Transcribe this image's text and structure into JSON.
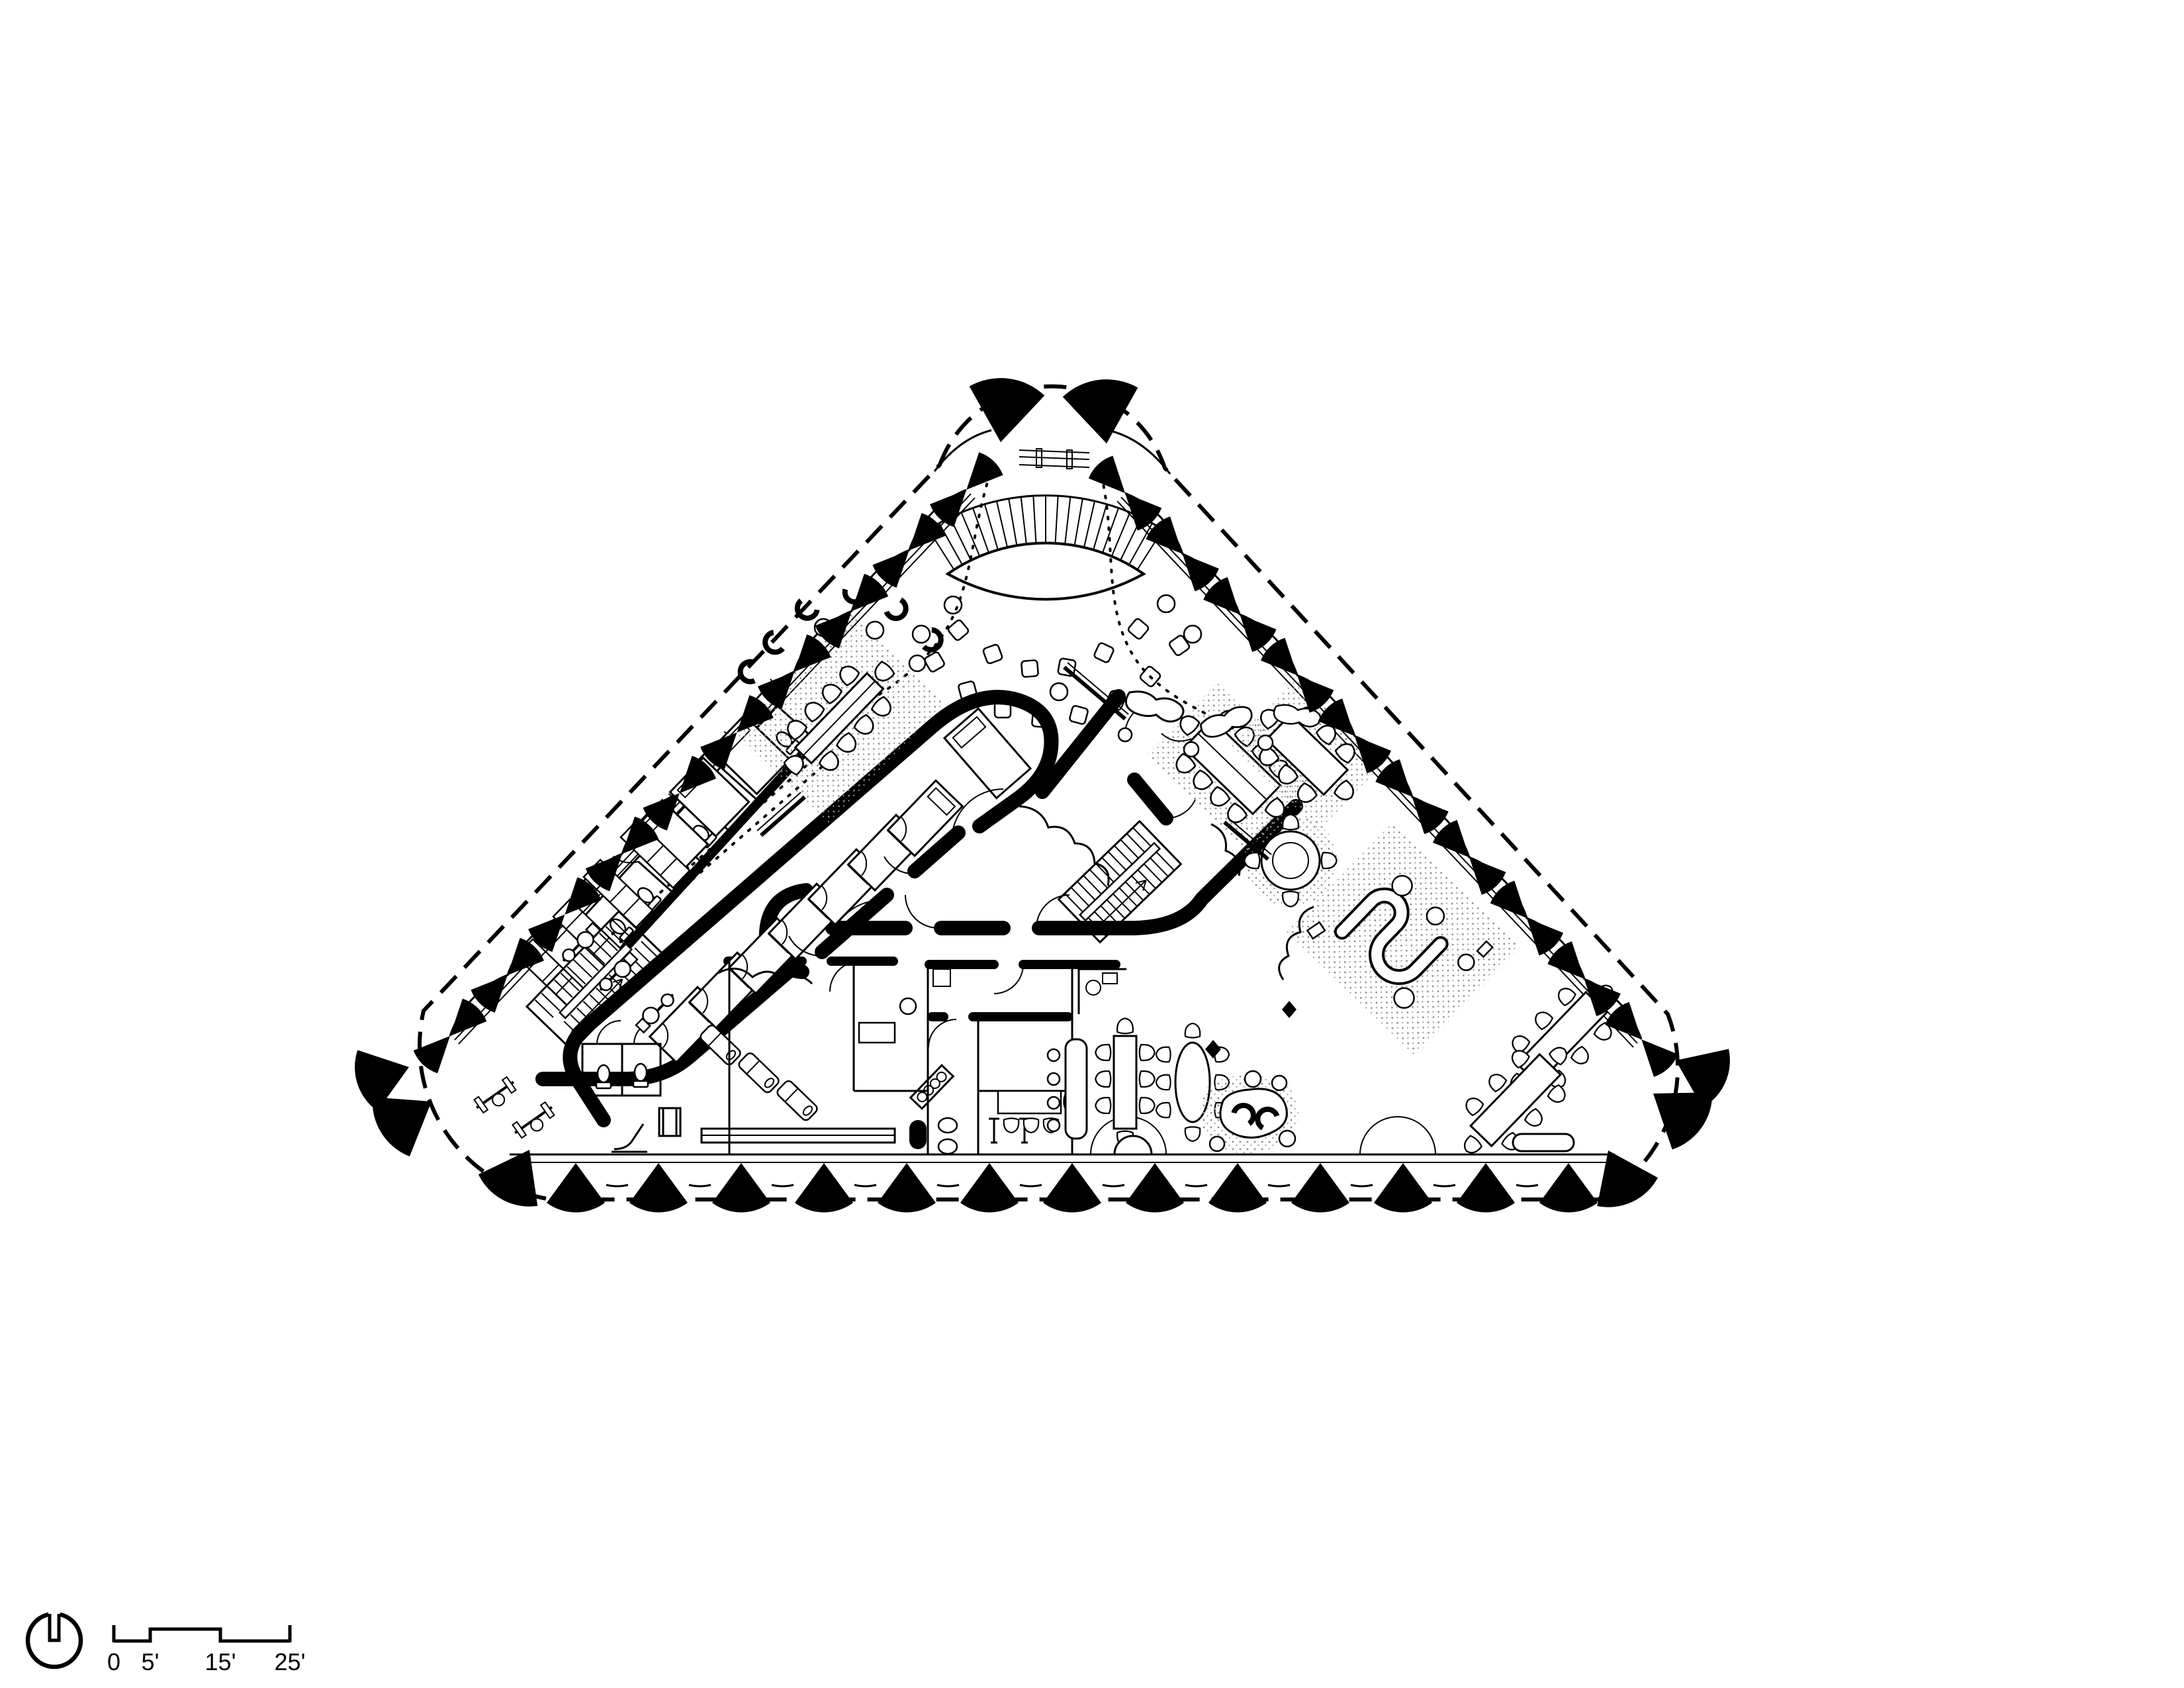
{
  "sheet": {
    "type": "architectural floor plan drawing",
    "background_color": "#ffffff",
    "ink_color": "#000000"
  },
  "scale_bar": {
    "unit": "feet",
    "tick_labels": [
      "0",
      "5'",
      "15'",
      "25'"
    ]
  },
  "north_arrow": {
    "icon": "north-arrow-circle-notch"
  },
  "plan_features": [
    "triangular-floor-plate",
    "scalloped-curtain-wall",
    "perimeter-bowtie-columns",
    "dashed-site-line",
    "fan-amphitheater-stair",
    "loose-pouf-seating",
    "focus-room-band",
    "central-stair",
    "switchback-stair",
    "restroom-stall-row",
    "fitness-area",
    "kitchen-dining-area",
    "meeting-rooms-with-rugs",
    "open-office-desk-clusters",
    "lounge-seating"
  ]
}
